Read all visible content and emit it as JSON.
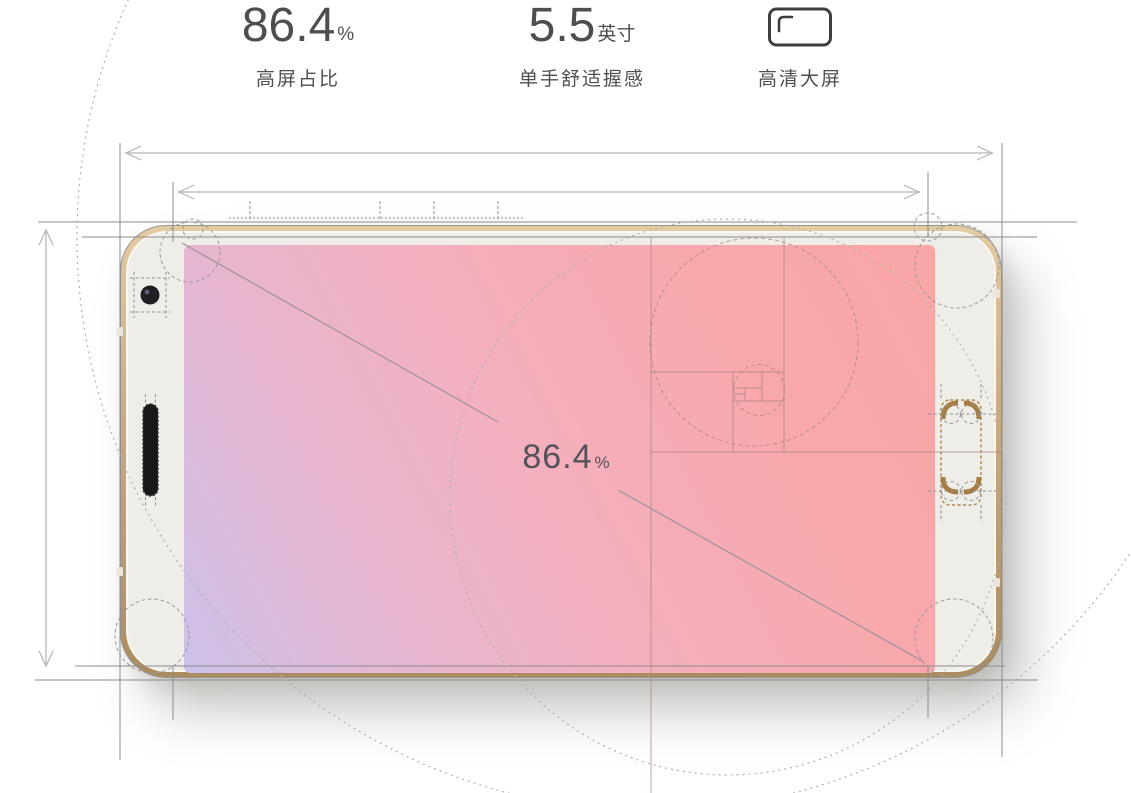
{
  "stats": {
    "items": [
      {
        "value": "86.4",
        "unit": "%",
        "label": "高屏占比"
      },
      {
        "value": "5.5",
        "unit": "英寸",
        "label": "单手舒适握感"
      },
      {
        "icon": "hd-screen-icon",
        "label": "高清大屏"
      }
    ]
  },
  "diagram": {
    "screen_label": {
      "value": "86.4",
      "unit": "%"
    }
  },
  "colors": {
    "screen_start": "#ccc1e9",
    "screen_mid1": "#e5b7d2",
    "screen_mid2": "#f4afbd",
    "screen_mid3": "#f8a8ac",
    "screen_end": "#f9a6a5",
    "frame_gold": "#c9a97d",
    "bezel": "#efede8",
    "component": "#b08a50",
    "construction_line": "#8c8c8c",
    "text": "#4e4e50"
  }
}
